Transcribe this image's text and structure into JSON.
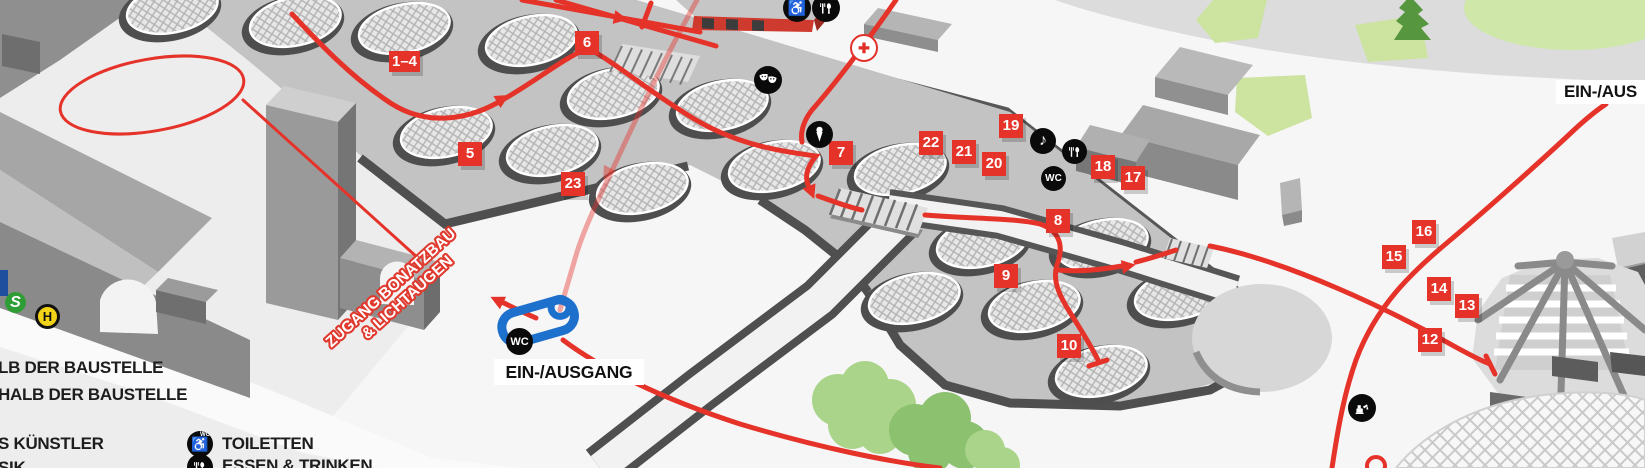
{
  "labels": {
    "entrance_main": "EIN-/AUSGANG",
    "entrance_right_partial": "EIN-/AUS",
    "zugang_line1": "ZUGANG BONATZBAU",
    "zugang_line2": "& LICHTAUGEN",
    "wc": "WC"
  },
  "transit": {
    "sbahn": "S",
    "bus_stop": "H"
  },
  "markers": [
    {
      "label": "1–4"
    },
    {
      "label": "5"
    },
    {
      "label": "6"
    },
    {
      "label": "23"
    },
    {
      "label": "7"
    },
    {
      "label": "8"
    },
    {
      "label": "9"
    },
    {
      "label": "10"
    },
    {
      "label": "12"
    },
    {
      "label": "13"
    },
    {
      "label": "14"
    },
    {
      "label": "15"
    },
    {
      "label": "16"
    },
    {
      "label": "17"
    },
    {
      "label": "18"
    },
    {
      "label": "19"
    },
    {
      "label": "20"
    },
    {
      "label": "21"
    },
    {
      "label": "22"
    }
  ],
  "legend": {
    "left_lines_partial": [
      {
        "text": "LB DER BAUSTELLE"
      },
      {
        "text": "HALB DER BAUSTELLE"
      },
      {
        "text": "S KÜNSTLER"
      },
      {
        "text": "SIK"
      }
    ],
    "items": [
      {
        "icon": "accessible-wc-icon",
        "label": "TOILETTEN"
      },
      {
        "icon": "food-icon",
        "label": "ESSEN & TRINKEN"
      }
    ]
  },
  "icons": {
    "music_glyph": "♪",
    "wheelchair_glyph": "♿",
    "first_aid_glyph": "✚"
  },
  "colors": {
    "route_red": "#e5332a",
    "highlight_blue": "#1d70cc",
    "sbahn_green": "#2f9d36",
    "bus_stop_yellow": "#f2d318",
    "first_aid_red": "#e03028"
  }
}
